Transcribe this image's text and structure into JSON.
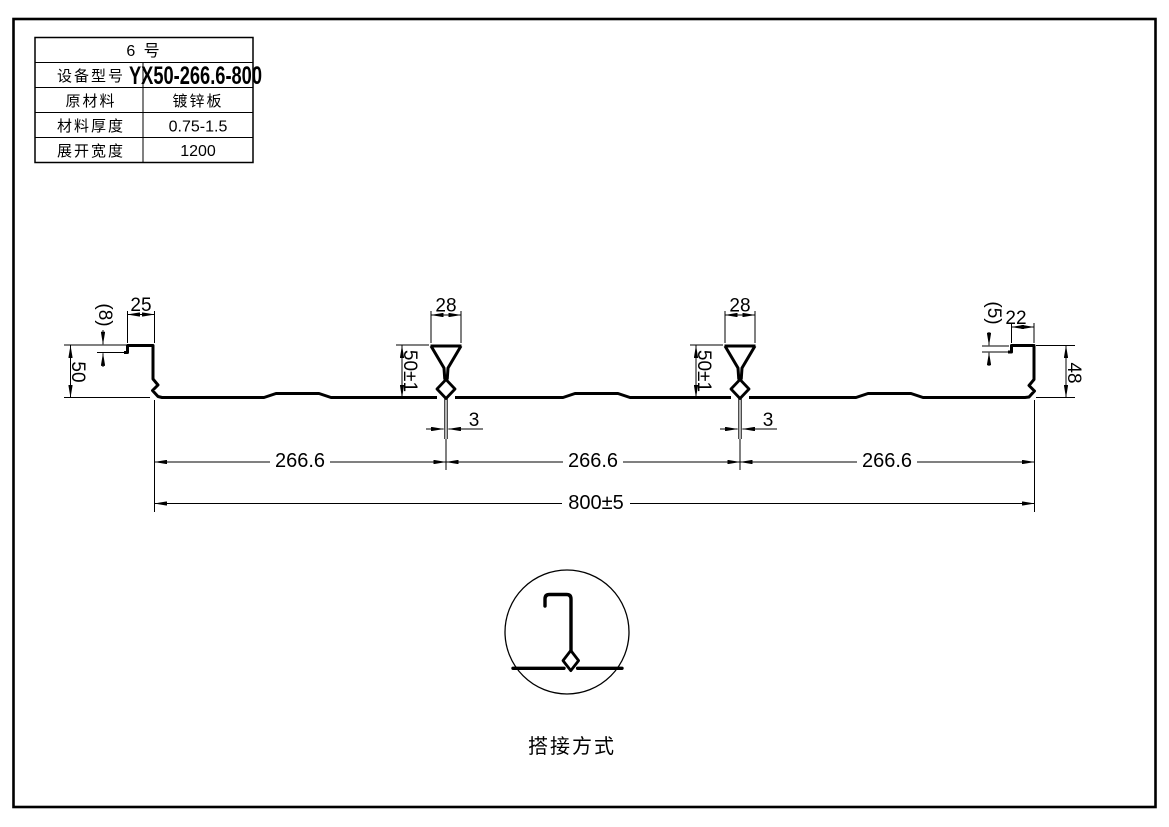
{
  "colors": {
    "ink": "#000000",
    "paper": "#ffffff"
  },
  "spec_table": {
    "title": "6  号",
    "rows": [
      {
        "label": "设备型号",
        "value": "YX50-266.6-800"
      },
      {
        "label": "原材料",
        "value": "镀锌板"
      },
      {
        "label": "材料厚度",
        "value": "0.75-1.5"
      },
      {
        "label": "展开宽度",
        "value": "1200"
      }
    ]
  },
  "profile": {
    "dims": {
      "left_edge_lip": "(8)",
      "left_top_flange": "25",
      "left_web_height": "50",
      "rib_top_width": "28",
      "rib_height": "50±1",
      "rib_seam_gap": "3",
      "right_edge_lip": "(5)",
      "right_top_flange": "22",
      "right_web_height": "48",
      "module_width": "266.6",
      "overall_width": "800±5"
    }
  },
  "detail_view": {
    "caption": "搭接方式"
  }
}
